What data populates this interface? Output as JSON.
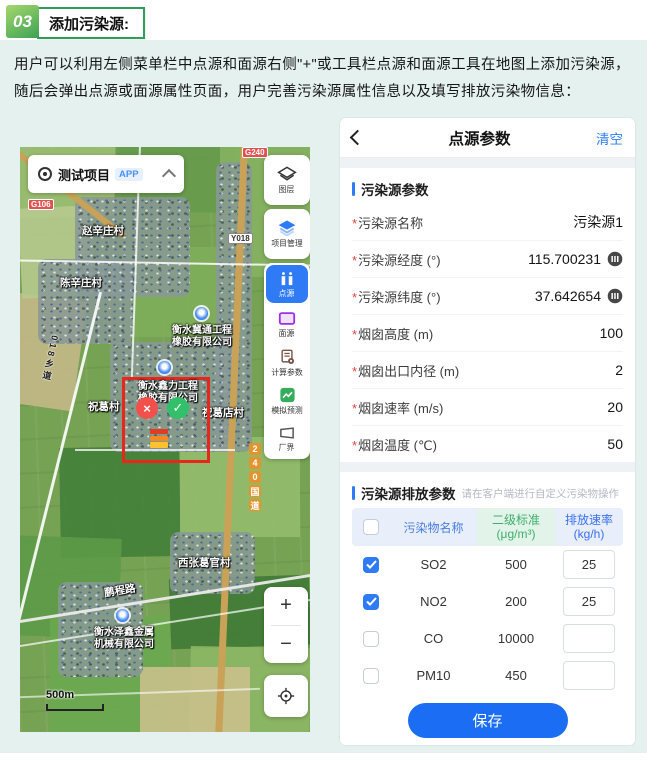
{
  "header": {
    "number": "03",
    "title": "添加污染源:"
  },
  "intro": "用户可以利用左侧菜单栏中点源和面源右侧\"+\"或工具栏点源和面源工具在地图上添加污染源，随后会弹出点源或面源属性页面，用户完善污染源属性信息以及填写排放污染物信息：",
  "map": {
    "project": {
      "name": "测试项目",
      "badge": "APP"
    },
    "toolbar": [
      {
        "label": "图层"
      },
      {
        "label": "项目管理"
      },
      {
        "label": "点源"
      },
      {
        "label": "面源"
      },
      {
        "label": "计算参数"
      },
      {
        "label": "模拟预测"
      },
      {
        "label": "厂界"
      }
    ],
    "zoom_in": "+",
    "zoom_out": "−",
    "scale": "500m",
    "badges": {
      "top": "G240",
      "left": "G106",
      "mid": "Y018"
    },
    "road_vertical": [
      "2",
      "4",
      "0",
      "国",
      "道"
    ],
    "road_left": "018乡道",
    "road_name": "鹏程路",
    "villages": [
      "赵辛庄村",
      "陈辛庄村",
      "祝葛村",
      "祝葛店村",
      "西张葛官村"
    ],
    "companies": [
      {
        "line1": "衡水冀通工程",
        "line2": "橡胶有限公司"
      },
      {
        "line1": "衡水鑫力工程",
        "line2": "橡胶有限公司"
      },
      {
        "line1": "衡水泽鑫金属",
        "line2": "机械有限公司"
      }
    ],
    "markers": {
      "x": "×",
      "check": "✓"
    }
  },
  "panel": {
    "title": "点源参数",
    "clear": "清空",
    "required_mark": "*",
    "section1": {
      "title": "污染源参数"
    },
    "fields": [
      {
        "label": "污染源名称",
        "value": "污染源1"
      },
      {
        "label": "污染源经度 (°)",
        "value": "115.700231"
      },
      {
        "label": "污染源纬度 (°)",
        "value": "37.642654"
      },
      {
        "label": "烟囱高度 (m)",
        "value": "100"
      },
      {
        "label": "烟囱出口内径 (m)",
        "value": "2"
      },
      {
        "label": "烟囱速率 (m/s)",
        "value": "20"
      },
      {
        "label": "烟囱温度 (℃)",
        "value": "50"
      }
    ],
    "section2": {
      "title": "污染源排放参数",
      "hint": "请在客户端进行自定义污染物操作"
    },
    "table": {
      "col_name": "污染物名称",
      "col_std_1": "二级标准",
      "col_std_2": "(μg/m³)",
      "col_rate_1": "排放速率",
      "col_rate_2": "(kg/h)",
      "header_cb_class": "cb",
      "rows": [
        {
          "name": "SO2",
          "std": "500",
          "rate": "25",
          "cb_class": "cb on"
        },
        {
          "name": "NO2",
          "std": "200",
          "rate": "25",
          "cb_class": "cb on"
        },
        {
          "name": "CO",
          "std": "10000",
          "rate": "",
          "cb_class": "cb"
        },
        {
          "name": "PM10",
          "std": "450",
          "rate": "",
          "cb_class": "cb"
        },
        {
          "name": "PM2.5",
          "std": "225",
          "rate": "",
          "cb_class": "cb"
        }
      ]
    },
    "save": "保存"
  }
}
